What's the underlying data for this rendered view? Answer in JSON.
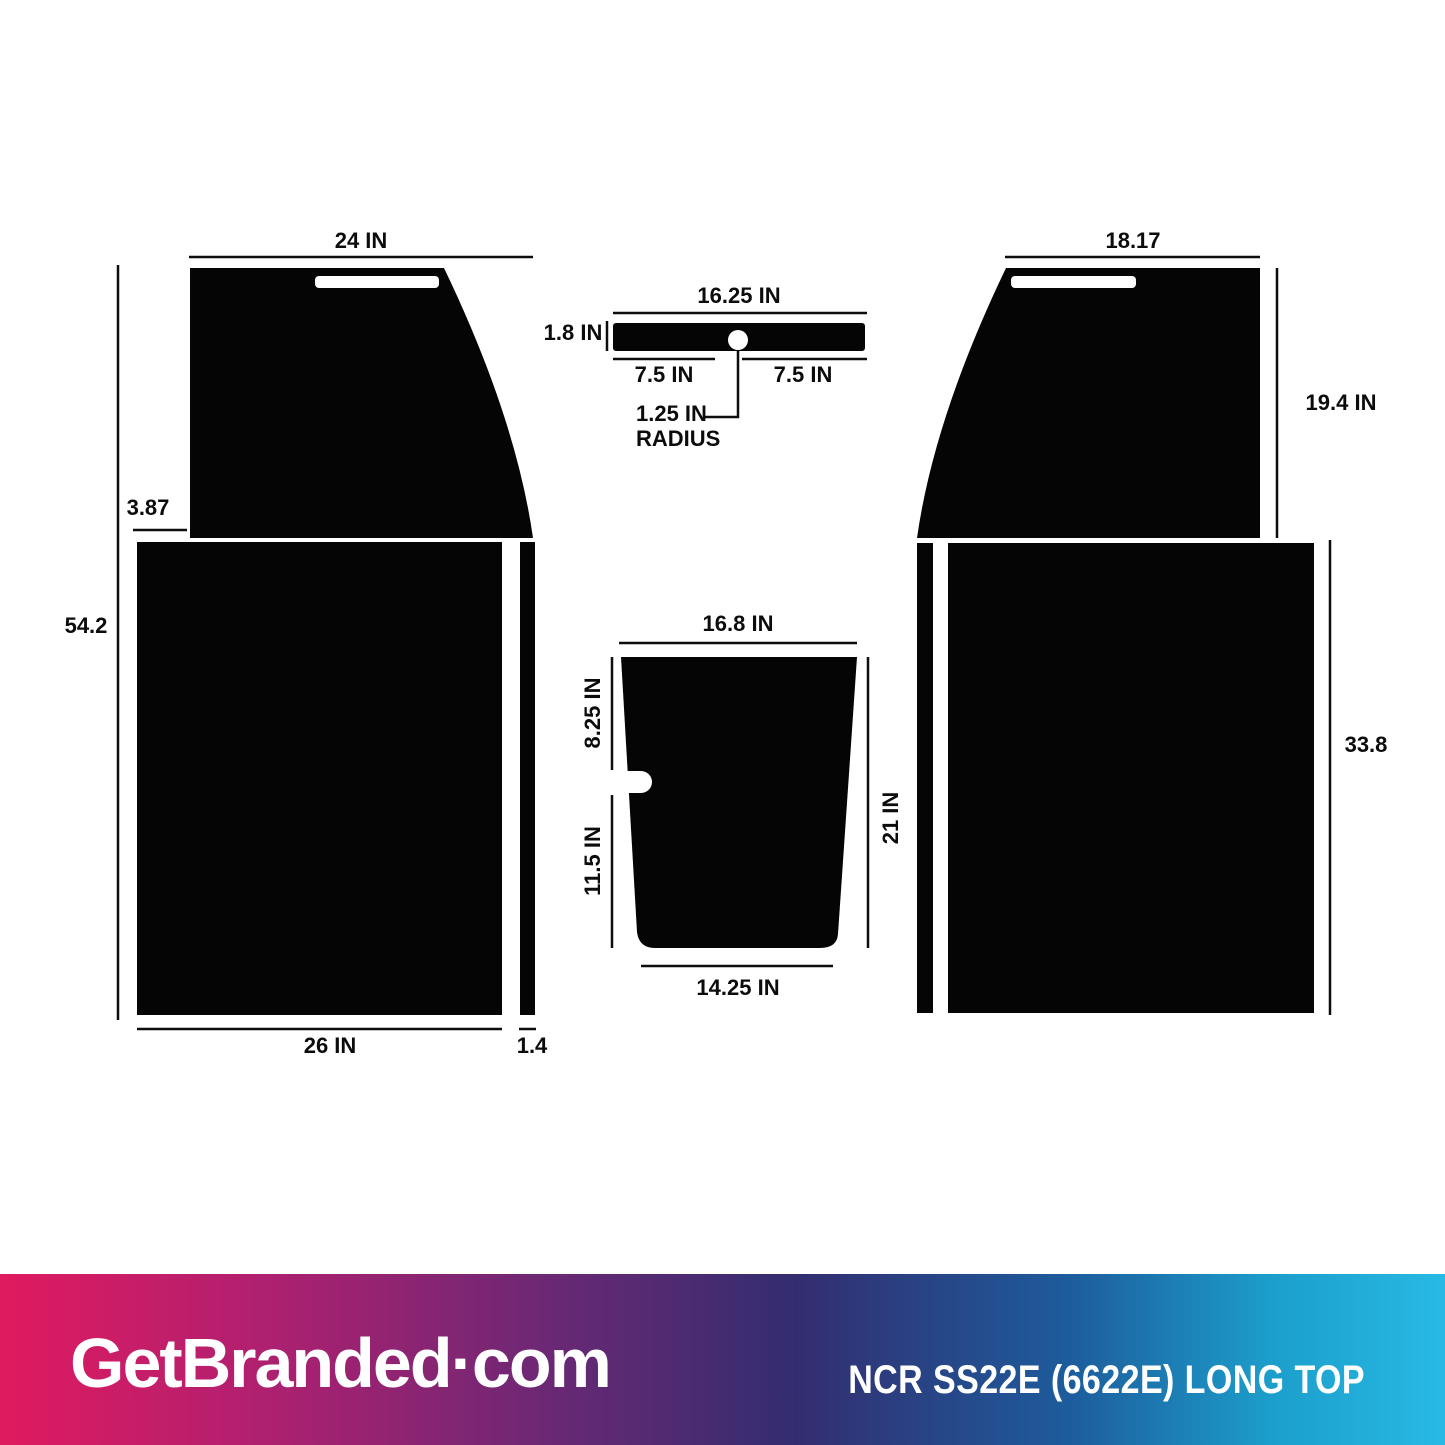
{
  "dims": {
    "left_top_width": "24 IN",
    "left_total_height": "54.2",
    "left_offset": "3.87",
    "left_base_width": "26 IN",
    "left_strip_width": "1.4",
    "bar_width": "16.25 IN",
    "bar_height": "1.8 IN",
    "bar_left_half": "7.5 IN",
    "bar_right_half": "7.5 IN",
    "hole_radius_value": "1.25 IN",
    "hole_radius_word": "RADIUS",
    "trap_top_width": "16.8 IN",
    "trap_upper_left_height": "8.25 IN",
    "trap_lower_left_height": "11.5 IN",
    "trap_right_height": "21 IN",
    "trap_bottom_width": "14.25 IN",
    "right_top_width": "18.17",
    "right_top_height": "19.4 IN",
    "right_base_height": "33.8"
  },
  "shapes": {
    "fill_color": "#050505",
    "line_color": "#0d0d0d",
    "background": "#ffffff"
  },
  "footer": {
    "brand": "GetBranded·com",
    "product_title": "NCR SS22E (6622E) LONG TOP",
    "text_color": "#ffffff",
    "gradient_stops": [
      "#E01A5F 0%",
      "#B02070 18%",
      "#6B2874 38%",
      "#332D70 55%",
      "#1D5C9C 74%",
      "#1C9ECB 88%",
      "#27BAE4 100%"
    ]
  }
}
